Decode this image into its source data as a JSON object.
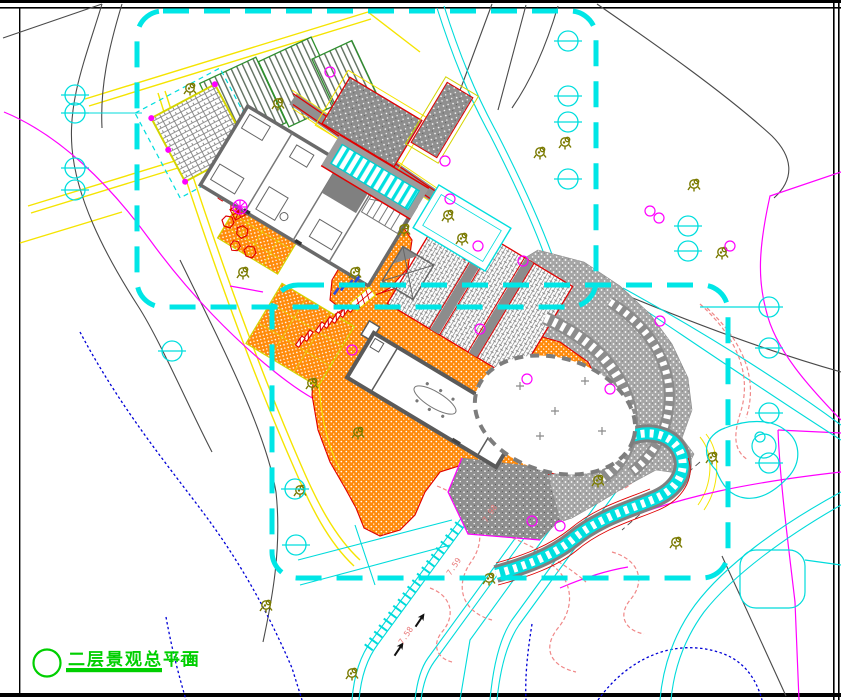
{
  "drawing": {
    "title": "二层景观总平面",
    "scale": "1:200",
    "road_labels": [
      "7.98",
      "7.59",
      "7.58"
    ],
    "palette": {
      "boundary_cyan": "#00E6E6",
      "road_cyan": "#00DBDB",
      "parcel_yellow": "#F5E400",
      "paving_orange": "#FF8A0A",
      "accent_red": "#E80000",
      "contour_gray": "#4A4A4A",
      "contour_magenta": "#FF00FF",
      "contour_blue": "#0000D6",
      "contour_salmon": "#F08888",
      "tree_olive": "#7A7A00",
      "title_green": "#00CF00",
      "plot_green": "#2F8F2F"
    }
  }
}
